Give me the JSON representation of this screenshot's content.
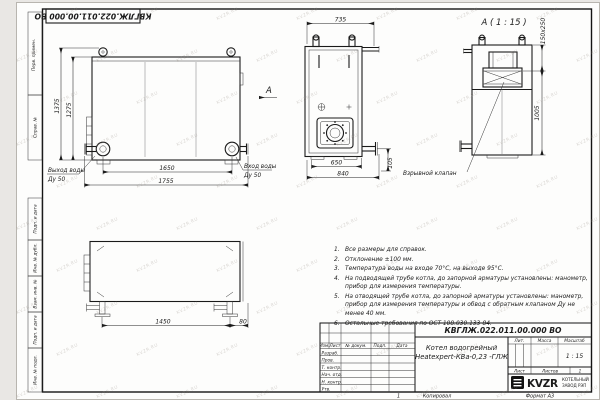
{
  "watermark": {
    "text": "KVZR.RU"
  },
  "frame": {
    "top_doc_number": "КВГЛЖ.022.011.00.000 ВО",
    "left_stamps_top": [
      "Перв. примен.",
      "Справ. №"
    ],
    "left_stamps_bottom": [
      "Подп. и дата",
      "Инв. № дубл.",
      "Взам. инв. №",
      "Подп. и дата",
      "Инв. № подл."
    ]
  },
  "front_view": {
    "dim_height_total": "1375",
    "dim_height_inner": "1275",
    "dim_width_inner": "1650",
    "dim_width_total": "1755",
    "outlet_label_line1": "Выход воды",
    "outlet_label_line2": "Ду 50",
    "inlet_label_line1": "Вход воды",
    "inlet_label_line2": "Ду 50",
    "view_arrow_label": "А"
  },
  "side_view": {
    "dim_top": "735",
    "dim_bottom_inner": "650",
    "dim_bottom_total": "840",
    "dim_right": "105"
  },
  "top_view": {
    "dim_width": "1450",
    "dim_offset": "80"
  },
  "detail_view": {
    "title": "А ( 1 : 15 )",
    "dim_valve": "150х250",
    "dim_height": "1005",
    "valve_label": "Взрывной клапан"
  },
  "notes": {
    "items": [
      {
        "num": "1.",
        "text": "Все размеры для справок."
      },
      {
        "num": "2.",
        "text": "Отклонение ±100 мм."
      },
      {
        "num": "3.",
        "text": "Температура воды на входе 70°С, на выходе 95°С."
      },
      {
        "num": "4.",
        "text": "На подводящей трубе котла, до запорной арматуры установлены: манометр, прибор для измерения температуры."
      },
      {
        "num": "5.",
        "text": "На отводящей трубе котла, до запорной арматуры установлены: манометр, прибор для измерения температуры и обвод с обратным клапаном Ду не менее 40 мм."
      },
      {
        "num": "6.",
        "text": "Остальные требования по ОСТ 108.030.133-84."
      }
    ]
  },
  "title_block": {
    "doc_number": "КВГЛЖ.022.011.00.000 ВО",
    "product_name_line1": "Котел водогрейный",
    "product_name_line2": "Heatexpert-КВа-0,23 -ГЛЖ",
    "col_izm": "Изм.",
    "col_list": "Лист",
    "col_doc": "№ докум.",
    "col_podp": "Подп.",
    "col_data": "Дата",
    "rows": [
      "Разраб.",
      "Пров.",
      "Т. контр.",
      "Нач. отд.",
      "Н. контр.",
      "Утв."
    ],
    "lit_label": "Лит.",
    "mass_label": "Масса",
    "scale_label": "Масштаб",
    "scale_value": "1 : 15",
    "sheet_label": "Лист",
    "sheets_label": "Листов",
    "sheets_value": "1",
    "logo_text": "KVZR",
    "company_line1": "КОТЕЛЬНЫЙ",
    "company_line2": "ЗАВОД РЭП",
    "footer_zone": "1",
    "footer_copy": "Копировал",
    "footer_format": "Формат А3"
  }
}
